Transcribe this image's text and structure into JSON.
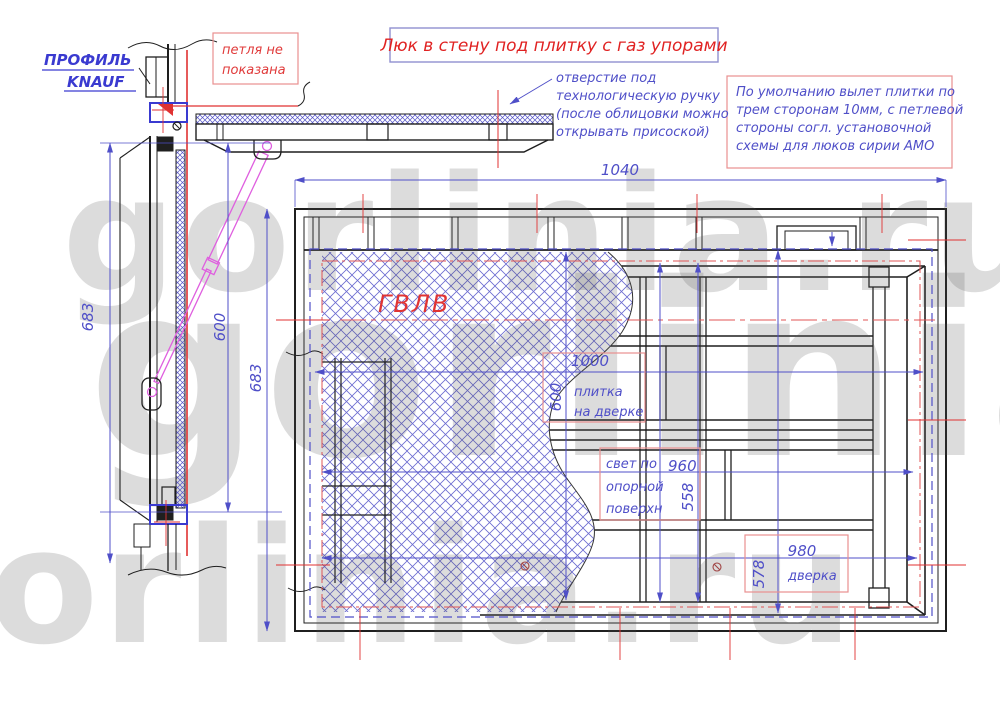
{
  "title": {
    "text": "Люк в стену под плитку с газ упорами"
  },
  "watermark": {
    "text": "gorlinia.ru"
  },
  "notes": {
    "profile_line1": "ПРОФИЛЬ",
    "profile_line2": "KNAUF",
    "hinge_line1": "петля не",
    "hinge_line2": "показана",
    "handle_line1": "отверстие под",
    "handle_line2": "технологическую ручку",
    "handle_line3": "(после облицовки можно",
    "handle_line4": "открывать присоской)",
    "default_line1": "По умолчанию вылет плитки по",
    "default_line2": "трем сторонам 10мм, с петлевой",
    "default_line3": "стороны согл. установочной",
    "default_line4": "схемы для люков  сирии АМО",
    "material": "ГВЛВ"
  },
  "dimensions": {
    "overall_width": "1040",
    "side_total_height": "683",
    "side_opening": "600",
    "front_height": "683",
    "tile_width": "1000",
    "tile_height": "600",
    "tile_label1": "плитка",
    "tile_label2": "на дверке",
    "clear_label1": "свет по",
    "clear_label2": "опорной",
    "clear_label3": "поверхн",
    "clear_width": "960",
    "clear_height": "558",
    "door_width": "980",
    "door_height": "578",
    "door_label": "дверка"
  },
  "colors": {
    "dim_blue": "#4f4fc8",
    "profile_blue": "#3a3ad0",
    "drawing_black": "#1f1f1f",
    "accent_red": "#e03232",
    "note_box_border": "#e89090",
    "title_box_border": "#9090d0",
    "strut_magenta": "#df5fdf",
    "hatch_blue": "#6b6bd0",
    "watermark_gray": "#d7d7d7"
  }
}
